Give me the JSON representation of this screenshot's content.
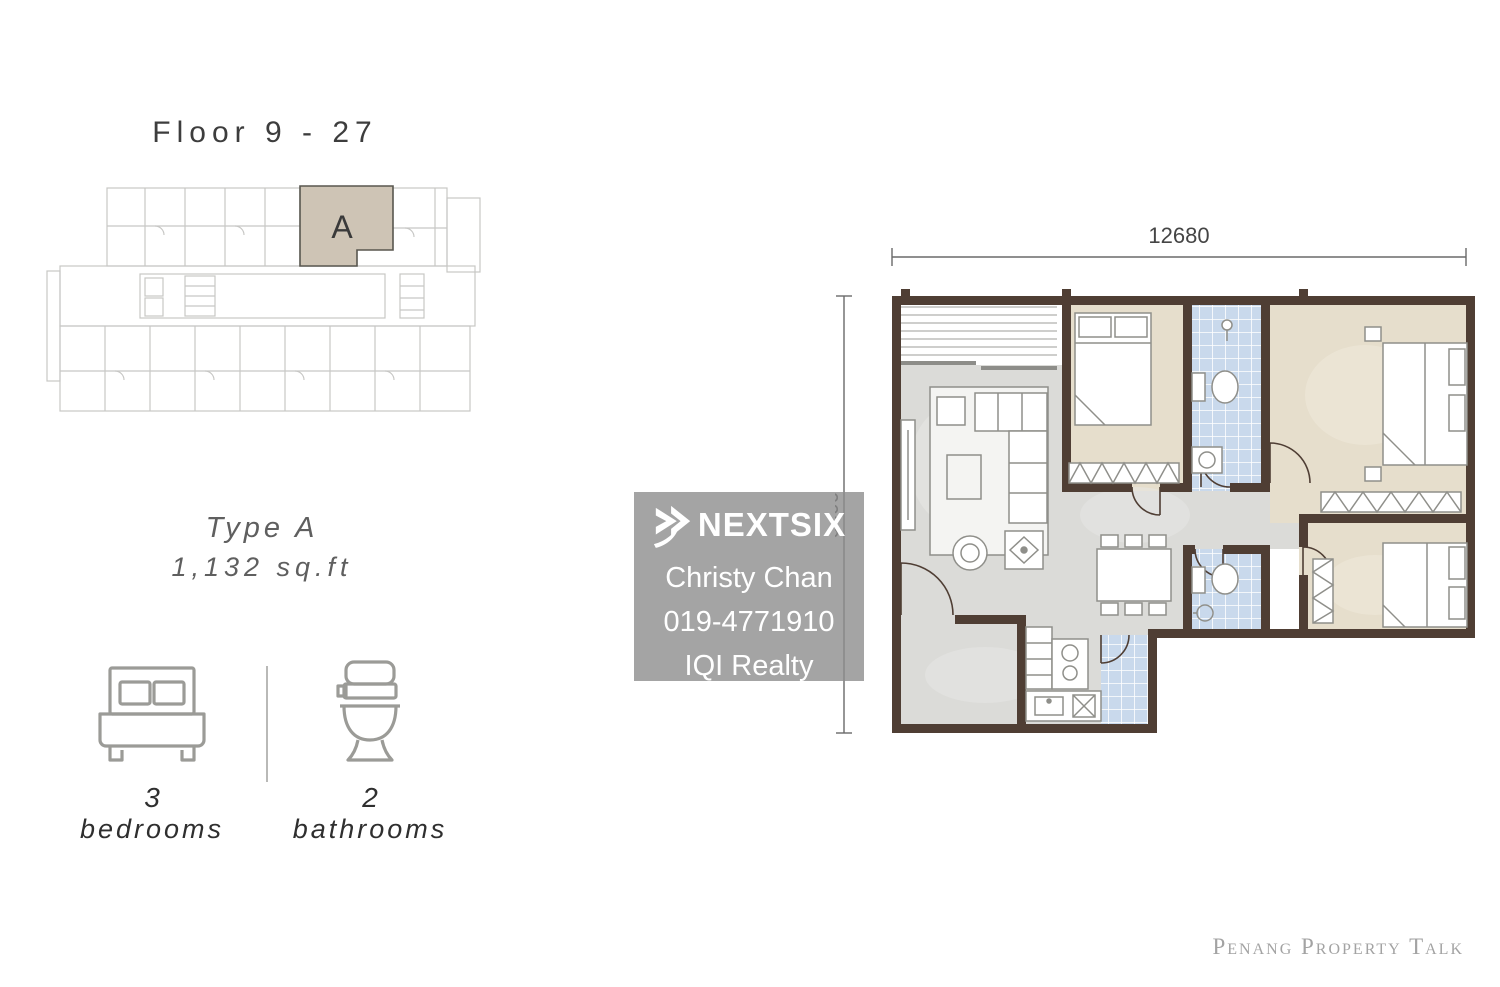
{
  "left_panel": {
    "floor_label": "Floor 9 - 27",
    "unit_letter": "A",
    "type_label": "Type A",
    "area_label": "1,132 sq.ft",
    "bedrooms_count": "3",
    "bedrooms_label": "bedrooms",
    "bathrooms_count": "2",
    "bathrooms_label": "bathrooms"
  },
  "floor_plan": {
    "width_dimension": "12680",
    "height_dimension": "9500",
    "colors": {
      "wall": "#4f3e34",
      "bedroom_floor": "#e6decc",
      "bathroom_tile": "#c9d9ec",
      "living_floor": "#dbdbd8",
      "unit_highlight": "#cec4b5",
      "keyplan_line": "#c7c7c5"
    }
  },
  "watermark": {
    "brand": "NEXTSIX",
    "agent_name": "Christy Chan",
    "agent_phone": "019-4771910",
    "agency": "IQI Realty"
  },
  "footer": {
    "credit": "Penang Property Talk"
  }
}
